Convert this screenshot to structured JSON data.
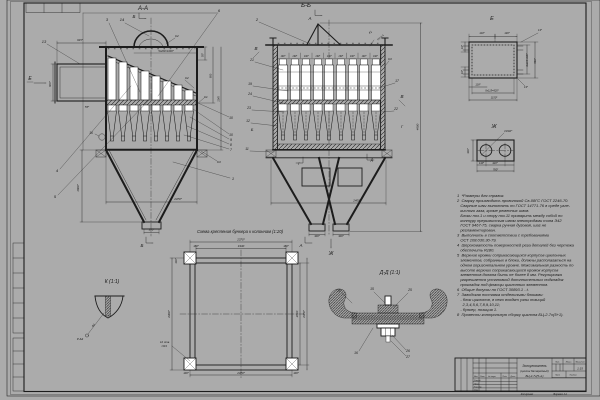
{
  "sheet": {
    "paper": "#ffffff",
    "ink": "#1c1c1c",
    "scan_edge": "#ababab"
  },
  "views": {
    "aa": {
      "title": "А-А",
      "texts": [
        {
          "t": "Б",
          "x": 134,
          "y": 18,
          "s": 4.5
        },
        {
          "t": "3",
          "x": 107,
          "y": 21,
          "s": 4
        },
        {
          "t": "14",
          "x": 122,
          "y": 21,
          "s": 4
        },
        {
          "t": "6",
          "x": 219,
          "y": 12,
          "s": 4
        },
        {
          "t": "13",
          "x": 44,
          "y": 43,
          "s": 4
        },
        {
          "t": "Е",
          "x": 30,
          "y": 80,
          "s": 5
        },
        {
          "t": "4",
          "x": 57,
          "y": 172,
          "s": 4
        },
        {
          "t": "5",
          "x": 55,
          "y": 198,
          "s": 4
        },
        {
          "t": "1",
          "x": 233,
          "y": 180,
          "s": 4
        },
        {
          "t": "10",
          "x": 231,
          "y": 119,
          "s": 3.4
        },
        {
          "t": "10",
          "x": 231,
          "y": 136,
          "s": 3.4
        },
        {
          "t": "9",
          "x": 231,
          "y": 141,
          "s": 3.4
        },
        {
          "t": "8",
          "x": 231,
          "y": 146,
          "s": 3.4
        },
        {
          "t": "7",
          "x": 231,
          "y": 151,
          "s": 3.4
        },
        {
          "t": "16",
          "x": 91,
          "y": 134,
          "s": 3.2
        },
        {
          "t": "К2",
          "x": 177,
          "y": 37,
          "s": 3
        },
        {
          "t": "К2",
          "x": 187,
          "y": 79,
          "s": 3
        },
        {
          "t": "К1",
          "x": 206,
          "y": 98,
          "s": 3
        },
        {
          "t": "К3",
          "x": 219,
          "y": 163,
          "s": 3
        },
        {
          "t": "915*",
          "x": 80,
          "y": 41,
          "s": 2.8
        },
        {
          "t": "55*",
          "x": 87,
          "y": 108,
          "s": 2.8
        },
        {
          "t": "900*",
          "x": 51,
          "y": 84,
          "s": 2.8,
          "r": -90
        },
        {
          "t": "5х200=1000*",
          "x": 166,
          "y": 52,
          "s": 2.6
        },
        {
          "t": "1600*",
          "x": 79,
          "y": 188,
          "s": 2.9,
          "r": -90
        },
        {
          "t": "2370*",
          "x": 178,
          "y": 200,
          "s": 2.9
        },
        {
          "t": "300*",
          "x": 151.5,
          "y": 230.5,
          "s": 2.8
        },
        {
          "t": "Б",
          "x": 142,
          "y": 247,
          "s": 4.5
        },
        {
          "t": "55*",
          "x": 203.5,
          "y": 55,
          "s": 2.6,
          "r": -90
        },
        {
          "t": "800",
          "x": 211.5,
          "y": 76,
          "s": 2.6,
          "r": -90
        },
        {
          "t": "1145",
          "x": 219.5,
          "y": 99,
          "s": 2.6,
          "r": -90
        }
      ]
    },
    "bb": {
      "title": "Б-Б",
      "texts": [
        {
          "t": "А",
          "x": 310,
          "y": 20,
          "s": 4.5
        },
        {
          "t": "2",
          "x": 257,
          "y": 21,
          "s": 4
        },
        {
          "t": "В",
          "x": 256,
          "y": 50,
          "s": 4.5
        },
        {
          "t": "21",
          "x": 252,
          "y": 61,
          "s": 3.4
        },
        {
          "t": "19",
          "x": 250,
          "y": 85,
          "s": 3.4
        },
        {
          "t": "24",
          "x": 250,
          "y": 95,
          "s": 3.4
        },
        {
          "t": "23",
          "x": 249,
          "y": 109,
          "s": 3.4
        },
        {
          "t": "12",
          "x": 248,
          "y": 122,
          "s": 3.4
        },
        {
          "t": "Б",
          "x": 252,
          "y": 131,
          "s": 4
        },
        {
          "t": "11",
          "x": 247,
          "y": 150,
          "s": 3.4
        },
        {
          "t": "К3",
          "x": 390,
          "y": 60,
          "s": 3
        },
        {
          "t": "17",
          "x": 397,
          "y": 82,
          "s": 3.4
        },
        {
          "t": "В",
          "x": 402,
          "y": 98,
          "s": 4.5
        },
        {
          "t": "22",
          "x": 396,
          "y": 110,
          "s": 3.4
        },
        {
          "t": "Г",
          "x": 402,
          "y": 128,
          "s": 4
        },
        {
          "t": "К1",
          "x": 371,
          "y": 33,
          "s": 2.8,
          "r": -38
        },
        {
          "t": "Н1-3,4",
          "x": 381,
          "y": 38,
          "s": 2.5,
          "r": -38
        },
        {
          "t": "4600",
          "x": 418.5,
          "y": 127,
          "s": 2.9,
          "r": -90
        },
        {
          "t": "2400*",
          "x": 357,
          "y": 201.5,
          "s": 2.9
        },
        {
          "t": "300*",
          "x": 317,
          "y": 237,
          "s": 2.6
        },
        {
          "t": "300*",
          "x": 341,
          "y": 237,
          "s": 2.6
        },
        {
          "t": "А",
          "x": 301,
          "y": 247,
          "s": 4.5
        },
        {
          "t": "Ж",
          "x": 331,
          "y": 255,
          "s": 5
        },
        {
          "t": "Г",
          "x": 299,
          "y": 165,
          "s": 3.4
        },
        {
          "t": "Д",
          "x": 372,
          "y": 161,
          "s": 3.4
        },
        {
          "t": "190*",
          "x": 283,
          "y": 57,
          "s": 2.3
        },
        {
          "t": "190*",
          "x": 294.8,
          "y": 57,
          "s": 2.3
        },
        {
          "t": "190*",
          "x": 306.3,
          "y": 57,
          "s": 2.3
        },
        {
          "t": "190*",
          "x": 317.8,
          "y": 57,
          "s": 2.3
        },
        {
          "t": "190*",
          "x": 329.3,
          "y": 57,
          "s": 2.3
        },
        {
          "t": "190*",
          "x": 340.8,
          "y": 57,
          "s": 2.3
        },
        {
          "t": "190*",
          "x": 352.3,
          "y": 57,
          "s": 2.3
        },
        {
          "t": "190*",
          "x": 364,
          "y": 57,
          "s": 2.3
        },
        {
          "t": "190*",
          "x": 375.5,
          "y": 57,
          "s": 2.3
        }
      ]
    },
    "e": {
      "title": "Е",
      "texts": [
        {
          "t": "110*",
          "x": 482,
          "y": 34,
          "s": 2.6
        },
        {
          "t": "130*",
          "x": 507,
          "y": 34,
          "s": 2.6
        },
        {
          "t": "13*",
          "x": 540,
          "y": 31,
          "s": 2.6
        },
        {
          "t": "10*",
          "x": 463,
          "y": 47,
          "s": 2.6,
          "r": -90
        },
        {
          "t": "10*",
          "x": 463,
          "y": 72,
          "s": 2.6,
          "r": -90
        },
        {
          "t": "3х210=630*",
          "x": 528,
          "y": 60,
          "s": 2.5,
          "r": -90
        },
        {
          "t": "860*",
          "x": 536,
          "y": 61,
          "s": 2.6,
          "r": -90
        },
        {
          "t": "118*",
          "x": 478,
          "y": 85.5,
          "s": 2.6
        },
        {
          "t": "8х115=920*",
          "x": 492,
          "y": 91.5,
          "s": 2.5
        },
        {
          "t": "13*",
          "x": 526,
          "y": 88,
          "s": 2.6
        },
        {
          "t": "1150*",
          "x": 494,
          "y": 98.5,
          "s": 2.6
        }
      ]
    },
    "zh": {
      "title": "Ж",
      "texts": [
        {
          "t": "∅202*",
          "x": 508,
          "y": 132,
          "s": 2.9
        },
        {
          "t": "300*",
          "x": 469,
          "y": 151,
          "s": 2.6,
          "r": -90
        },
        {
          "t": "140*",
          "x": 481.5,
          "y": 164,
          "s": 2.6
        },
        {
          "t": "420*",
          "x": 495,
          "y": 164,
          "s": 2.6
        },
        {
          "t": "760*",
          "x": 495.5,
          "y": 170.5,
          "s": 2.6
        }
      ]
    },
    "k": {
      "title": "К (1:1)",
      "texts": [
        {
          "t": "∆4",
          "x": 94,
          "y": 326,
          "s": 2.9,
          "r": -40
        },
        {
          "t": "Р-∆3",
          "x": 80,
          "y": 340,
          "s": 2.9
        }
      ]
    },
    "dd": {
      "title": "Д-Д (1:1)",
      "texts": [
        {
          "t": "20",
          "x": 339,
          "y": 292,
          "s": 3.4
        },
        {
          "t": "15",
          "x": 372,
          "y": 290,
          "s": 3.4
        },
        {
          "t": "25",
          "x": 410,
          "y": 291,
          "s": 3.4
        },
        {
          "t": "16",
          "x": 356,
          "y": 354,
          "s": 3.4
        },
        {
          "t": "26",
          "x": 408,
          "y": 352,
          "s": 3.4
        },
        {
          "t": "27",
          "x": 408,
          "y": 358,
          "s": 3.4
        }
      ]
    },
    "schema": {
      "title": "Схема крепления бункера к колоннам (1:20)",
      "texts": [
        {
          "t": "2370*",
          "x": 241,
          "y": 240.5,
          "s": 2.9
        },
        {
          "t": "1930",
          "x": 241,
          "y": 247,
          "s": 2.9
        },
        {
          "t": "180*",
          "x": 196,
          "y": 247,
          "s": 2.6
        },
        {
          "t": "180*",
          "x": 286,
          "y": 247,
          "s": 2.6
        },
        {
          "t": "100*",
          "x": 177,
          "y": 261,
          "s": 2.6,
          "r": -90
        },
        {
          "t": "2400*",
          "x": 170,
          "y": 314,
          "s": 2.9,
          "r": -90
        },
        {
          "t": "2210",
          "x": 298,
          "y": 314,
          "s": 2.9,
          "r": -90
        },
        {
          "t": "2370*",
          "x": 305,
          "y": 314,
          "s": 2.9,
          "r": -90
        },
        {
          "t": "2370*",
          "x": 241,
          "y": 374,
          "s": 2.9
        },
        {
          "t": "100*",
          "x": 186,
          "y": 374,
          "s": 2.6
        },
        {
          "t": "100*",
          "x": 296,
          "y": 374,
          "s": 2.6
        },
        {
          "t": "12 отв.",
          "x": 165,
          "y": 343,
          "s": 2.8
        },
        {
          "t": "∅23",
          "x": 164,
          "y": 347,
          "s": 2.8
        }
      ]
    }
  },
  "notes": {
    "lines": [
      "1  *Размеры для справок.",
      "2  Сварку производить проволокой Св-08ГС ГОСТ 2246-70.",
      "   Сварные швы выполнять по ГОСТ 14771-76 в среде угле-",
      "   кислого газа, кроме ременных швов.",
      "   Блоки поз.1 и опору поз.11 приварить между собой по",
      "   контуру прерывистым швом электродами типа Э42",
      "   ГОСТ 9467-75, сварка ручная дуговая, шаг не",
      "   регламентирован.",
      "3  Выполнить в соответствии с требованиями",
      "   ОСТ 108.030.30-79.",
      "4  Шероховатость поверхностей реза деталей без чертежа",
      "   обеспечить Rz80.",
      "5  Верхние кромки соприкасающихся корпусов циклонных",
      "   элементов, собранных в блоки, должны располагаться на",
      "   одном горизонтальном уровне. Максимальная разность по",
      "   высоте верхних соприкасающихся кромок корпусов",
      "   элементов должна быть не более 8 мм. Регулировка",
      "   разрешается установкой дополнительных подкладок",
      "   прокладок под фланцы циклонных элементов.",
      "6  Общие допуски по ГОСТ 30893.1 - t.",
      "7  Заводская поставка отдельными блоками:",
      "   - блок циклонов, в него входят узлы позиций",
      "     2,3,4,5,6,7,8,9,10,11;",
      "   - бункер, позиция 1.",
      "8  Провести контрольную сборку циклона БЦ-2-7х(5+1)."
    ]
  },
  "titleblock": {
    "texts": [
      {
        "t": "Золоуловитель",
        "x": 534.5,
        "y": 367,
        "s": 3.3
      },
      {
        "t": "(циклон батарейный)",
        "x": 534.5,
        "y": 372,
        "s": 2.8
      },
      {
        "t": "БЦ-2-7х(5+1)",
        "x": 534.5,
        "y": 377,
        "s": 3
      },
      {
        "t": "1:15",
        "x": 580,
        "y": 369.5,
        "s": 3
      },
      {
        "t": "Лит.",
        "x": 557.5,
        "y": 362.5,
        "s": 1.9
      },
      {
        "t": "Масса",
        "x": 568.5,
        "y": 362.5,
        "s": 1.9
      },
      {
        "t": "Масштаб",
        "x": 580,
        "y": 362.5,
        "s": 1.9
      },
      {
        "t": "Лист",
        "x": 557.5,
        "y": 375.5,
        "s": 1.9
      },
      {
        "t": "Листов",
        "x": 573,
        "y": 375.5,
        "s": 1.9
      },
      {
        "t": "Изм.",
        "x": 474,
        "y": 377,
        "s": 1.8,
        "a": "s"
      },
      {
        "t": "Лист",
        "x": 480,
        "y": 377,
        "s": 1.8,
        "a": "s"
      },
      {
        "t": "№ докум.",
        "x": 488,
        "y": 377,
        "s": 1.8,
        "a": "s"
      },
      {
        "t": "Подп.",
        "x": 502.5,
        "y": 377,
        "s": 1.8,
        "a": "s"
      },
      {
        "t": "Дата",
        "x": 510.5,
        "y": 377,
        "s": 1.8,
        "a": "s"
      },
      {
        "t": "Разраб.",
        "x": 474,
        "y": 381,
        "s": 1.9,
        "a": "s"
      },
      {
        "t": "Пров.",
        "x": 474,
        "y": 384.3,
        "s": 1.9,
        "a": "s"
      },
      {
        "t": "Н.контр.",
        "x": 474,
        "y": 387.6,
        "s": 1.9,
        "a": "s"
      },
      {
        "t": "Утв.",
        "x": 474,
        "y": 390.6,
        "s": 1.9,
        "a": "s"
      },
      {
        "t": "Копировал",
        "x": 527,
        "y": 394.8,
        "s": 2.5
      },
      {
        "t": "Формат А1",
        "x": 560,
        "y": 394.8,
        "s": 2.5
      }
    ]
  }
}
